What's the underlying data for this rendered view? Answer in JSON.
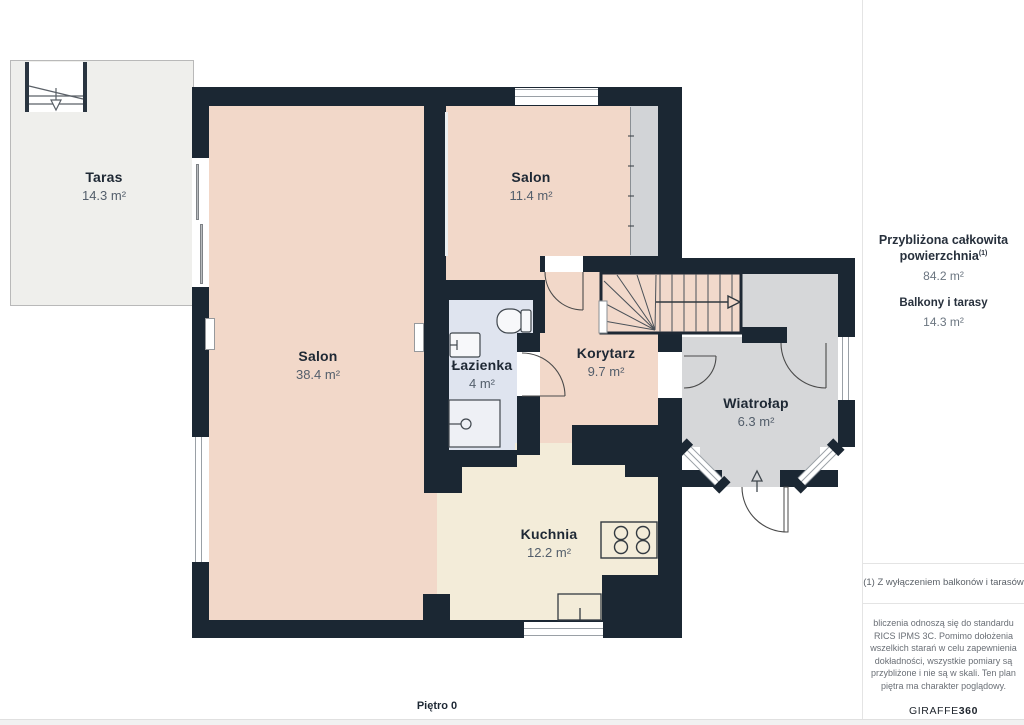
{
  "plan": {
    "floor_label": "Piętro 0",
    "rooms": [
      {
        "id": "taras",
        "name": "Taras",
        "area": "14.3 m²"
      },
      {
        "id": "salon-small",
        "name": "Salon",
        "area": "11.4 m²"
      },
      {
        "id": "salon-large",
        "name": "Salon",
        "area": "38.4 m²"
      },
      {
        "id": "lazienka",
        "name": "Łazienka",
        "area": "4 m²"
      },
      {
        "id": "korytarz",
        "name": "Korytarz",
        "area": "9.7 m²"
      },
      {
        "id": "wiatrolap",
        "name": "Wiatrołap",
        "area": "6.3 m²"
      },
      {
        "id": "kuchnia",
        "name": "Kuchnia",
        "area": "12.2 m²"
      }
    ],
    "colors": {
      "wall": "#1b2733",
      "room_peach": "#f2d8c9",
      "room_cream": "#f3ecd9",
      "room_blue": "#dfe4ef",
      "room_gray": "#d6d7d9",
      "terrace": "#efefec"
    }
  },
  "sidebar": {
    "total_label_line1": "Przybliżona całkowita",
    "total_label_line2": "powierzchnia",
    "footnote_marker": "(1)",
    "total_value": "84.2 m²",
    "balconies_label": "Balkony i tarasy",
    "balconies_value": "14.3 m²",
    "footnote": "(1) Z wyłączeniem balkonów i tarasów",
    "disclaimer_lines": [
      "bliczenia odnoszą się do standardu",
      "RICS IPMS 3C. Pomimo dołożenia",
      "wszelkich starań w celu zapewnienia",
      "dokładności, wszystkie pomiary są",
      "przybliżone i nie są w skali. Ten plan",
      "piętra ma charakter poglądowy."
    ],
    "brand_name": "GIRAFFE",
    "brand_number": "360"
  }
}
